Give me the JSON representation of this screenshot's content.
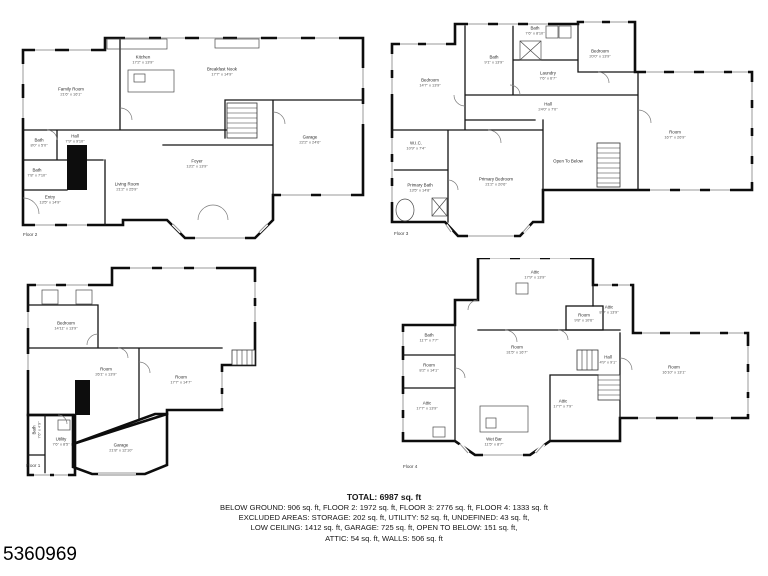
{
  "listing_id": "5360969",
  "summary": {
    "total": "TOTAL: 6987 sq. ft",
    "areas_line": "BELOW GROUND: 906 sq. ft, FLOOR 2: 1972 sq. ft, FLOOR 3: 2776 sq. ft, FLOOR 4: 1333 sq. ft",
    "excluded_line1": "EXCLUDED AREAS: STORAGE: 202 sq. ft, UTILITY: 52 sq. ft, UNDEFINED: 43 sq. ft,",
    "excluded_line2": "LOW CEILING: 1412 sq. ft, GARAGE: 725 sq. ft, OPEN TO BELOW: 151 sq. ft,",
    "excluded_line3": "ATTIC: 54 sq. ft, WALLS: 506 sq. ft"
  },
  "floors": [
    {
      "label": "Floor 2",
      "rooms": [
        {
          "name": "Kitchen",
          "dims": "17'2\" x 13'9\""
        },
        {
          "name": "Breakfast Nook",
          "dims": "17'7\" x 14'9\""
        },
        {
          "name": "Family Room",
          "dims": "21'6\" x 16'1\""
        },
        {
          "name": "Hall",
          "dims": "7'9\" x 9'10\""
        },
        {
          "name": "Bath",
          "dims": "8'0\" x 5'0\""
        },
        {
          "name": "Bath",
          "dims": "7'8\" x 7'10\""
        },
        {
          "name": "Foyer",
          "dims": "13'2\" x 13'9\""
        },
        {
          "name": "Entry",
          "dims": "13'5\" x 14'9\""
        },
        {
          "name": "Living Room",
          "dims": "21'2\" x 25'9\""
        },
        {
          "name": "Garage",
          "dims": "22'2\" x 24'6\""
        }
      ]
    },
    {
      "label": "Floor 3",
      "rooms": [
        {
          "name": "Bedroom",
          "dims": "14'7\" x 13'9\""
        },
        {
          "name": "Bath",
          "dims": "9'1\" x 13'9\""
        },
        {
          "name": "Bath",
          "dims": "7'6\" x 8'10\""
        },
        {
          "name": "Laundry",
          "dims": "7'6\" x 6'7\""
        },
        {
          "name": "Bedroom",
          "dims": "20'0\" x 13'9\""
        },
        {
          "name": "Hall",
          "dims": "24'0\" x 7'0\""
        },
        {
          "name": "Open To Below",
          "dims": ""
        },
        {
          "name": "Room",
          "dims": "16'7\" x 26'9\""
        },
        {
          "name": "W.I.C.",
          "dims": "10'9\" x 7'4\""
        },
        {
          "name": "Primary Bath",
          "dims": "13'5\" x 14'8\""
        },
        {
          "name": "Primary Bedroom",
          "dims": "21'2\" x 20'6\""
        }
      ]
    },
    {
      "label": "Floor 1",
      "rooms": [
        {
          "name": "Bedroom",
          "dims": "14'11\" x 13'9\""
        },
        {
          "name": "Room",
          "dims": "26'1\" x 13'9\""
        },
        {
          "name": "Room",
          "dims": "17'7\" x 14'7\""
        },
        {
          "name": "Bath",
          "dims": "7'6\" x 4'9\""
        },
        {
          "name": "Utility",
          "dims": "7'6\" x 8'5\""
        },
        {
          "name": "Garage",
          "dims": "21'8\" x 12'10\""
        }
      ]
    },
    {
      "label": "Floor 4",
      "rooms": [
        {
          "name": "Attic",
          "dims": "17'9\" x 13'9\""
        },
        {
          "name": "Attic",
          "dims": "8'9\" x 13'9\""
        },
        {
          "name": "Bath",
          "dims": "11'7\" x 7'7\""
        },
        {
          "name": "Room",
          "dims": "8'2\" x 14'1\""
        },
        {
          "name": "Room",
          "dims": "31'5\" x 16'7\""
        },
        {
          "name": "Room",
          "dims": "9'8\" x 10'6\""
        },
        {
          "name": "Hall",
          "dims": "4'9\" x 9'1\""
        },
        {
          "name": "Room",
          "dims": "16'10\" x 13'1\""
        },
        {
          "name": "Attic",
          "dims": "17'7\" x 13'9\""
        },
        {
          "name": "Attic",
          "dims": "17'7\" x 7'9\""
        },
        {
          "name": "Wet Bar",
          "dims": "11'5\" x 8'7\""
        }
      ]
    }
  ]
}
